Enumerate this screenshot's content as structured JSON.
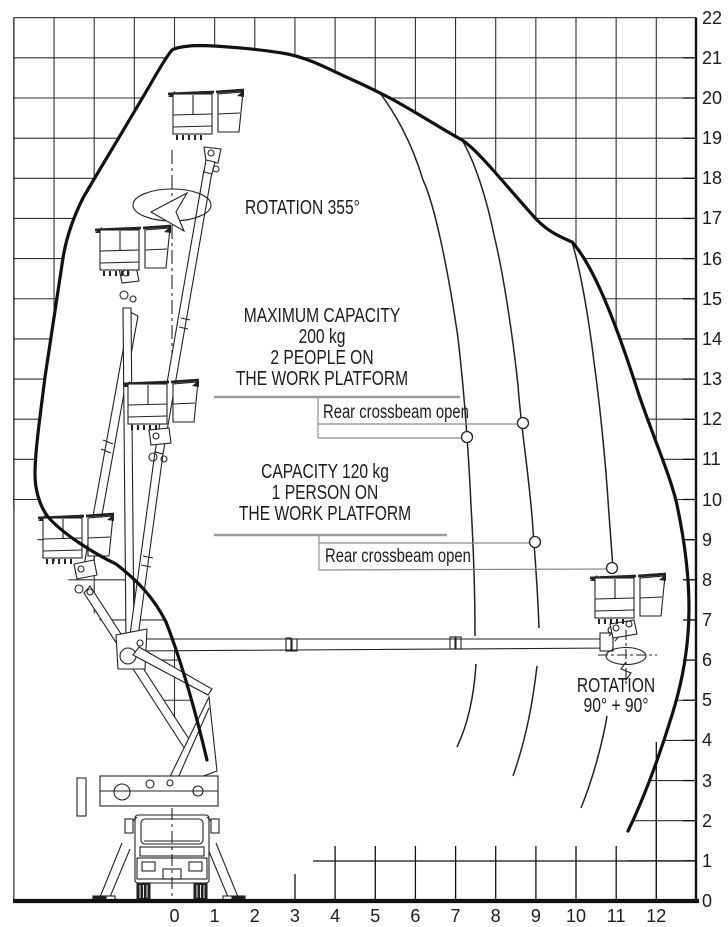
{
  "labels": {
    "rotation_355": "ROTATION 355°",
    "max_capacity": [
      "MAXIMUM CAPACITY",
      "200 kg",
      "2 PEOPLE ON",
      "THE WORK PLATFORM"
    ],
    "rear_crossbeam_upper": "Rear crossbeam open",
    "capacity_120": [
      "CAPACITY 120 kg",
      "1 PERSON ON",
      "THE WORK PLATFORM"
    ],
    "rear_crossbeam_lower": "Rear crossbeam open",
    "rotation_right": [
      "ROTATION",
      "90° + 90°"
    ]
  },
  "axes": {
    "x": {
      "min": -4,
      "max": 13,
      "labels": [
        "0",
        "1",
        "2",
        "3",
        "4",
        "5",
        "6",
        "7",
        "8",
        "9",
        "10",
        "11",
        "12"
      ]
    },
    "y": {
      "min": 0,
      "max": 22,
      "labels": [
        "0",
        "1",
        "2",
        "3",
        "4",
        "5",
        "6",
        "7",
        "8",
        "9",
        "10",
        "11",
        "12",
        "13",
        "14",
        "15",
        "16",
        "17",
        "18",
        "19",
        "20",
        "21",
        "22"
      ]
    }
  },
  "colors": {
    "line": "#1c1c1c",
    "leader_gray": "#9b9b9b",
    "grid": "#303030"
  },
  "chart_data": {
    "type": "area",
    "title": "Aerial work platform working envelope (height m vs outreach m)",
    "xlabel": "",
    "ylabel": "",
    "x_range": [
      -4,
      13
    ],
    "y_range": [
      0,
      22
    ],
    "grid": "on (outside envelope only)",
    "series": [
      {
        "name": "envelope-boundary",
        "points": [
          [
            0.8,
            3.5
          ],
          [
            -0.2,
            5.0
          ],
          [
            -1.3,
            7.2
          ],
          [
            -2.3,
            8.6
          ],
          [
            -3.1,
            9.6
          ],
          [
            -3.46,
            10.65
          ],
          [
            -3.4,
            11.9
          ],
          [
            -3.2,
            13.05
          ],
          [
            -2.75,
            15.2
          ],
          [
            -2.3,
            17.5
          ],
          [
            -1.6,
            19.6
          ],
          [
            -0.6,
            20.9
          ],
          [
            0.1,
            21.3
          ],
          [
            1.0,
            21.35
          ],
          [
            2.0,
            21.3
          ],
          [
            2.75,
            21.15
          ],
          [
            3.9,
            20.65
          ],
          [
            5.1,
            20.15
          ],
          [
            6.4,
            19.35
          ],
          [
            7.15,
            19.0
          ],
          [
            8.3,
            17.8
          ],
          [
            9.9,
            16.4
          ],
          [
            10.9,
            14.5
          ],
          [
            11.9,
            12.0
          ],
          [
            12.5,
            9.9
          ],
          [
            12.8,
            8.3
          ],
          [
            12.85,
            7.3
          ],
          [
            12.7,
            6.0
          ],
          [
            12.4,
            4.7
          ],
          [
            11.8,
            3.3
          ],
          [
            11.3,
            1.75
          ]
        ]
      },
      {
        "name": "capacity-200kg-inner-limit",
        "points": [
          [
            5.1,
            20.15
          ],
          [
            5.9,
            17.9
          ],
          [
            6.6,
            15.4
          ],
          [
            7.0,
            13.3
          ],
          [
            7.3,
            11.55
          ],
          [
            7.45,
            10.0
          ],
          [
            7.5,
            8.5
          ],
          [
            7.5,
            7.3
          ],
          [
            7.45,
            6.6
          ],
          [
            7.35,
            5.6
          ],
          [
            7.2,
            4.8
          ],
          [
            7.05,
            3.85
          ]
        ]
      },
      {
        "name": "capacity-200kg-rear-crossbeam-limit",
        "points": [
          [
            7.15,
            19.0
          ],
          [
            7.7,
            16.6
          ],
          [
            8.2,
            14.2
          ],
          [
            8.55,
            12.8
          ],
          [
            8.7,
            11.9
          ],
          [
            8.9,
            10.2
          ],
          [
            9.0,
            8.95
          ],
          [
            9.1,
            7.6
          ],
          [
            9.1,
            6.8
          ],
          [
            8.9,
            5.6
          ],
          [
            8.6,
            4.5
          ],
          [
            8.4,
            3.1
          ]
        ]
      },
      {
        "name": "capacity-120kg-rear-crossbeam-limit",
        "points": [
          [
            9.9,
            16.4
          ],
          [
            10.2,
            14.5
          ],
          [
            10.5,
            12.5
          ],
          [
            10.8,
            10.3
          ],
          [
            10.9,
            8.3
          ],
          [
            10.8,
            4.6
          ],
          [
            10.6,
            3.8
          ],
          [
            10.4,
            3.0
          ],
          [
            10.1,
            2.3
          ]
        ]
      }
    ],
    "markers": [
      {
        "label": "Rear crossbeam open",
        "points": [
          [
            7.3,
            11.55
          ],
          [
            8.7,
            11.9
          ]
        ]
      },
      {
        "label": "Rear crossbeam open",
        "points": [
          [
            9.0,
            8.95
          ],
          [
            10.9,
            8.3
          ]
        ]
      }
    ],
    "annotations": [
      "ROTATION 355°",
      "MAXIMUM CAPACITY 200 kg 2 PEOPLE ON THE WORK PLATFORM",
      "CAPACITY 120 kg 1 PERSON ON THE WORK PLATFORM",
      "ROTATION 90° + 90°"
    ]
  }
}
